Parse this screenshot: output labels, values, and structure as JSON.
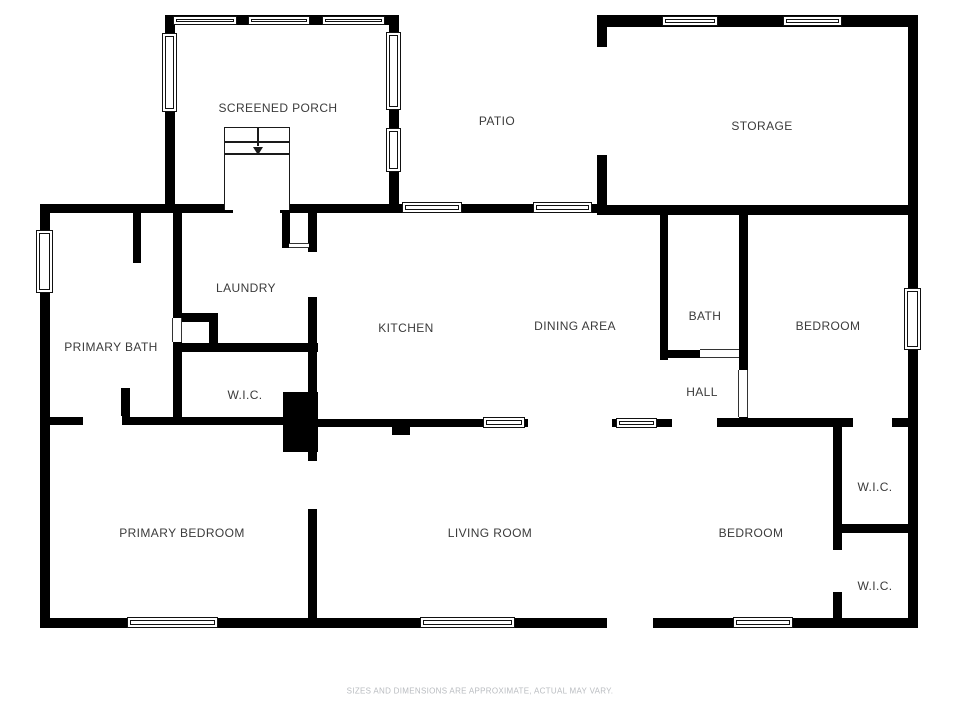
{
  "title": "Floor Plan",
  "colors": {
    "background": "#ffffff",
    "wall": "#000000",
    "label": "#3b3b3b",
    "disclaimer": "#b9bcc0"
  },
  "disclaimer": "SIZES AND DIMENSIONS ARE APPROXIMATE, ACTUAL MAY VARY.",
  "rooms": [
    {
      "label": "SCREENED PORCH",
      "x": 278,
      "y": 108
    },
    {
      "label": "PATIO",
      "x": 497,
      "y": 121
    },
    {
      "label": "STORAGE",
      "x": 762,
      "y": 126
    },
    {
      "label": "LAUNDRY",
      "x": 246,
      "y": 288
    },
    {
      "label": "PRIMARY BATH",
      "x": 111,
      "y": 347
    },
    {
      "label": "KITCHEN",
      "x": 406,
      "y": 328
    },
    {
      "label": "DINING AREA",
      "x": 575,
      "y": 326
    },
    {
      "label": "BATH",
      "x": 705,
      "y": 316
    },
    {
      "label": "BEDROOM",
      "x": 828,
      "y": 326
    },
    {
      "label": "W.I.C.",
      "x": 245,
      "y": 395
    },
    {
      "label": "HALL",
      "x": 702,
      "y": 392
    },
    {
      "label": "PRIMARY BEDROOM",
      "x": 182,
      "y": 533
    },
    {
      "label": "LIVING ROOM",
      "x": 490,
      "y": 533
    },
    {
      "label": "BEDROOM",
      "x": 751,
      "y": 533
    },
    {
      "label": "W.I.C.",
      "x": 875,
      "y": 487
    },
    {
      "label": "W.I.C.",
      "x": 875,
      "y": 586
    }
  ],
  "floorplan": {
    "walls": [
      {
        "name": "left-outer-wall",
        "x": 40,
        "y": 204,
        "w": 10,
        "h": 424
      },
      {
        "name": "top-main-wall",
        "x": 40,
        "y": 204,
        "w": 567,
        "h": 9
      },
      {
        "name": "bottom-outer-wall",
        "x": 40,
        "y": 618,
        "w": 878,
        "h": 10
      },
      {
        "name": "right-outer-wall",
        "x": 908,
        "y": 15,
        "w": 10,
        "h": 613
      },
      {
        "name": "porch-left-wall",
        "x": 165,
        "y": 15,
        "w": 10,
        "h": 198
      },
      {
        "name": "porch-top-wall",
        "x": 165,
        "y": 15,
        "w": 233,
        "h": 10
      },
      {
        "name": "porch-right-wall",
        "x": 389,
        "y": 15,
        "w": 10,
        "h": 198
      },
      {
        "name": "storage-top-wall",
        "x": 597,
        "y": 15,
        "w": 321,
        "h": 12
      },
      {
        "name": "storage-left-wall",
        "x": 597,
        "y": 18,
        "w": 10,
        "h": 197
      },
      {
        "name": "storage-bottom-wall",
        "x": 597,
        "y": 205,
        "w": 321,
        "h": 10
      },
      {
        "name": "primary-bath-right-wall",
        "x": 173,
        "y": 213,
        "w": 9,
        "h": 212
      },
      {
        "name": "laundry-nook-wall-h",
        "x": 173,
        "y": 313,
        "w": 45,
        "h": 9
      },
      {
        "name": "laundry-nook-wall-v",
        "x": 209,
        "y": 313,
        "w": 9,
        "h": 30
      },
      {
        "name": "wic-top-wall",
        "x": 173,
        "y": 343,
        "w": 145,
        "h": 9
      },
      {
        "name": "vestibule-left-wall",
        "x": 282,
        "y": 213,
        "w": 8,
        "h": 35
      },
      {
        "name": "kitchen-left-wall-upper",
        "x": 308,
        "y": 213,
        "w": 9,
        "h": 39
      },
      {
        "name": "kitchen-left-wall-main",
        "x": 308,
        "y": 297,
        "w": 9,
        "h": 331
      },
      {
        "name": "chimney-block",
        "x": 283,
        "y": 392,
        "w": 35,
        "h": 60
      },
      {
        "name": "living-room-pier",
        "x": 392,
        "y": 427,
        "w": 18,
        "h": 8
      },
      {
        "name": "primary-bedroom-top-wall",
        "x": 40,
        "y": 417,
        "w": 270,
        "h": 8
      },
      {
        "name": "primary-bedroom-stub",
        "x": 121,
        "y": 388,
        "w": 9,
        "h": 37
      },
      {
        "name": "primary-bath-stub",
        "x": 133,
        "y": 212,
        "w": 8,
        "h": 51
      },
      {
        "name": "living-top-wall-west",
        "x": 318,
        "y": 419,
        "w": 210,
        "h": 8
      },
      {
        "name": "living-top-wall-east",
        "x": 612,
        "y": 419,
        "w": 60,
        "h": 8
      },
      {
        "name": "dining-bath-wall",
        "x": 660,
        "y": 212,
        "w": 8,
        "h": 148
      },
      {
        "name": "bath-bottom-wall",
        "x": 660,
        "y": 350,
        "w": 40,
        "h": 8
      },
      {
        "name": "bath-right-wall",
        "x": 739,
        "y": 212,
        "w": 9,
        "h": 215
      },
      {
        "name": "bedroom-top-wall-west",
        "x": 717,
        "y": 418,
        "w": 136,
        "h": 9
      },
      {
        "name": "bedroom-top-wall-east",
        "x": 892,
        "y": 418,
        "w": 26,
        "h": 9
      },
      {
        "name": "bedroom-wic-wall",
        "x": 833,
        "y": 427,
        "w": 9,
        "h": 191
      },
      {
        "name": "wic-divider-wall",
        "x": 840,
        "y": 524,
        "w": 70,
        "h": 9
      }
    ],
    "windows": [
      {
        "name": "porch-top-window-1",
        "x": 173,
        "y": 16,
        "w": 64,
        "h": 9
      },
      {
        "name": "porch-top-window-2",
        "x": 248,
        "y": 16,
        "w": 62,
        "h": 9
      },
      {
        "name": "porch-top-window-3",
        "x": 322,
        "y": 16,
        "w": 63,
        "h": 9
      },
      {
        "name": "porch-left-window",
        "x": 162,
        "y": 33,
        "w": 15,
        "h": 79
      },
      {
        "name": "porch-right-window-1",
        "x": 386,
        "y": 32,
        "w": 15,
        "h": 78
      },
      {
        "name": "porch-right-window-2",
        "x": 386,
        "y": 128,
        "w": 15,
        "h": 44
      },
      {
        "name": "storage-top-window-1",
        "x": 662,
        "y": 16,
        "w": 56,
        "h": 10
      },
      {
        "name": "storage-top-window-2",
        "x": 783,
        "y": 16,
        "w": 59,
        "h": 10
      },
      {
        "name": "patio-door-window-1",
        "x": 402,
        "y": 202,
        "w": 60,
        "h": 11
      },
      {
        "name": "patio-door-window-2",
        "x": 533,
        "y": 202,
        "w": 59,
        "h": 11
      },
      {
        "name": "left-wall-window",
        "x": 36,
        "y": 230,
        "w": 17,
        "h": 63
      },
      {
        "name": "bedroom-east-window",
        "x": 904,
        "y": 288,
        "w": 17,
        "h": 62
      },
      {
        "name": "dining-hall-window",
        "x": 616,
        "y": 418,
        "w": 41,
        "h": 10
      },
      {
        "name": "primary-bedroom-window",
        "x": 127,
        "y": 617,
        "w": 91,
        "h": 11
      },
      {
        "name": "living-room-window",
        "x": 483,
        "y": 417,
        "w": 42,
        "h": 11
      },
      {
        "name": "living-south-window",
        "x": 420,
        "y": 617,
        "w": 95,
        "h": 11
      },
      {
        "name": "bedroom-south-window",
        "x": 733,
        "y": 617,
        "w": 60,
        "h": 11
      }
    ],
    "door_frames": [
      {
        "name": "primary-bath-door",
        "x": 172,
        "y": 318,
        "w": 10,
        "h": 24,
        "orient": "v"
      },
      {
        "name": "vestibule-door",
        "x": 289,
        "y": 243,
        "w": 20,
        "h": 5,
        "orient": "h"
      },
      {
        "name": "bath-door",
        "x": 700,
        "y": 349,
        "w": 39,
        "h": 9,
        "orient": "h"
      },
      {
        "name": "hall-bath-door",
        "x": 738,
        "y": 370,
        "w": 10,
        "h": 47,
        "orient": "v"
      }
    ],
    "door_gaps": [
      {
        "name": "porch-entry-opening",
        "x": 233,
        "y": 202,
        "w": 47,
        "h": 12
      },
      {
        "name": "primary-bedroom-door",
        "x": 83,
        "y": 416,
        "w": 39,
        "h": 10
      },
      {
        "name": "primary-bedroom-door-2",
        "x": 307,
        "y": 461,
        "w": 11,
        "h": 48
      },
      {
        "name": "wic-lower-door",
        "x": 832,
        "y": 550,
        "w": 11,
        "h": 42
      },
      {
        "name": "front-door-opening",
        "x": 607,
        "y": 617,
        "w": 46,
        "h": 12
      },
      {
        "name": "storage-patio-opening",
        "x": 596,
        "y": 47,
        "w": 12,
        "h": 108
      }
    ],
    "stairs": {
      "x": 224,
      "y": 127,
      "w": 66,
      "h": 83,
      "treads": [
        13,
        25
      ],
      "stem_h": 18,
      "arrow_y": 19
    }
  }
}
